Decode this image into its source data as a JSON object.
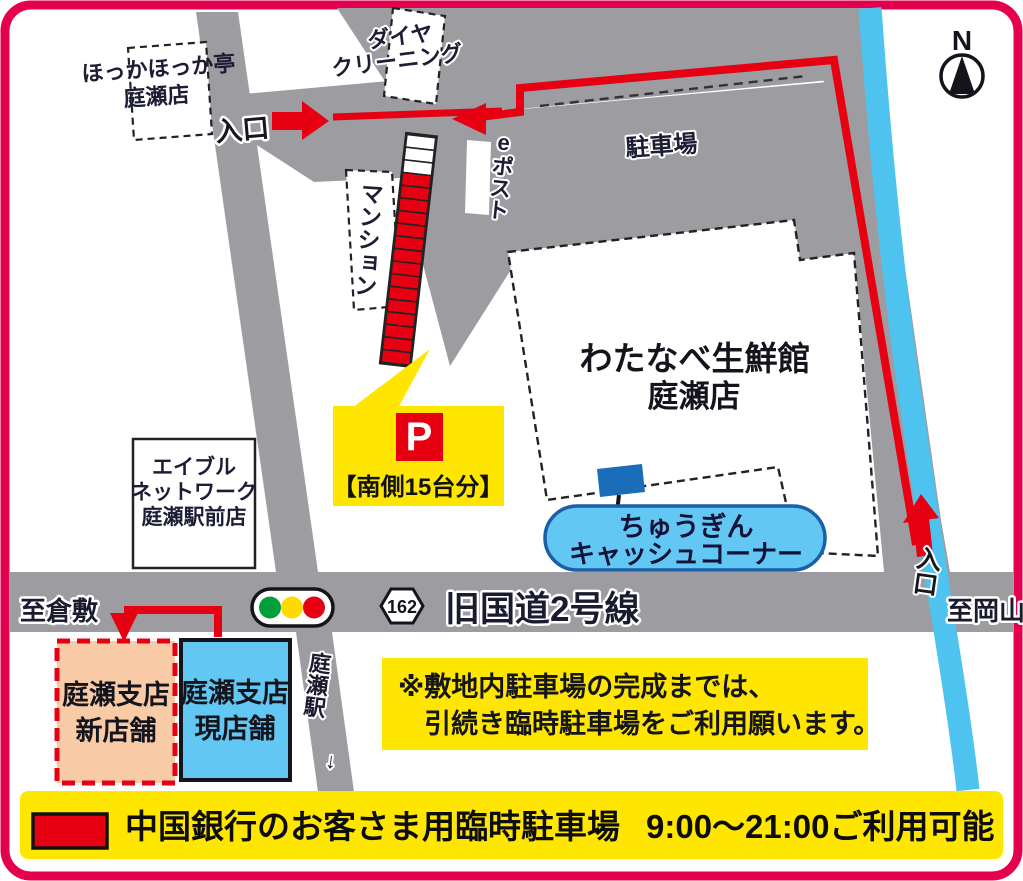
{
  "map": {
    "compass": "N",
    "colors": {
      "border_pink": "#e5004f",
      "road_gray": "#9c9ca1",
      "river_blue": "#4ec3ef",
      "route_red": "#e60012",
      "map_yellow": "#ffe600",
      "light_blue": "#62c7f2",
      "salmon": "#f8cba6",
      "marker_blue": "#1a6db8",
      "signal_green": "#009f3c",
      "signal_yellow": "#ffd900",
      "signal_red": "#e60012"
    },
    "landmarks": {
      "hokka": {
        "line1": "ほっかほっか亭",
        "line2": "庭瀬店"
      },
      "daiya": {
        "line1": "ダイヤ",
        "line2": "クリーニング"
      },
      "mansion": "マンション",
      "epost": "eポスト",
      "parking_lot": "駐車場",
      "supermarket": {
        "line1": "わたなべ生鮮館",
        "line2": "庭瀬店"
      },
      "able": {
        "line1": "エイブル",
        "line2": "ネットワーク",
        "line3": "庭瀬駅前店"
      },
      "chugin_atm": {
        "line1": "ちゅうぎん",
        "line2": "キャッシュコーナー"
      }
    },
    "parking_callout": {
      "p": "P",
      "capacity": "【南側15台分】"
    },
    "parking_strip": {
      "white_cells": 3,
      "red_cells": 15
    },
    "roads": {
      "route_badge": "162",
      "road_name": "旧国道2号線",
      "to_west": "至倉敷",
      "to_east": "至岡山",
      "station": {
        "name": "庭瀬駅",
        "arrow": "↓"
      }
    },
    "entrances": {
      "west": "入口",
      "south": "入口"
    },
    "branches": {
      "new": {
        "line1": "庭瀬支店",
        "line2": "新店舗"
      },
      "current": {
        "line1": "庭瀬支店",
        "line2": "現店舗"
      }
    },
    "note": {
      "line1": "※敷地内駐車場の完成までは、",
      "line2": "引続き臨時駐車場をご利用願います。"
    },
    "legend": {
      "text": "中国銀行のお客さま用臨時駐車場",
      "hours": "9:00～21:00ご利用可能"
    }
  }
}
